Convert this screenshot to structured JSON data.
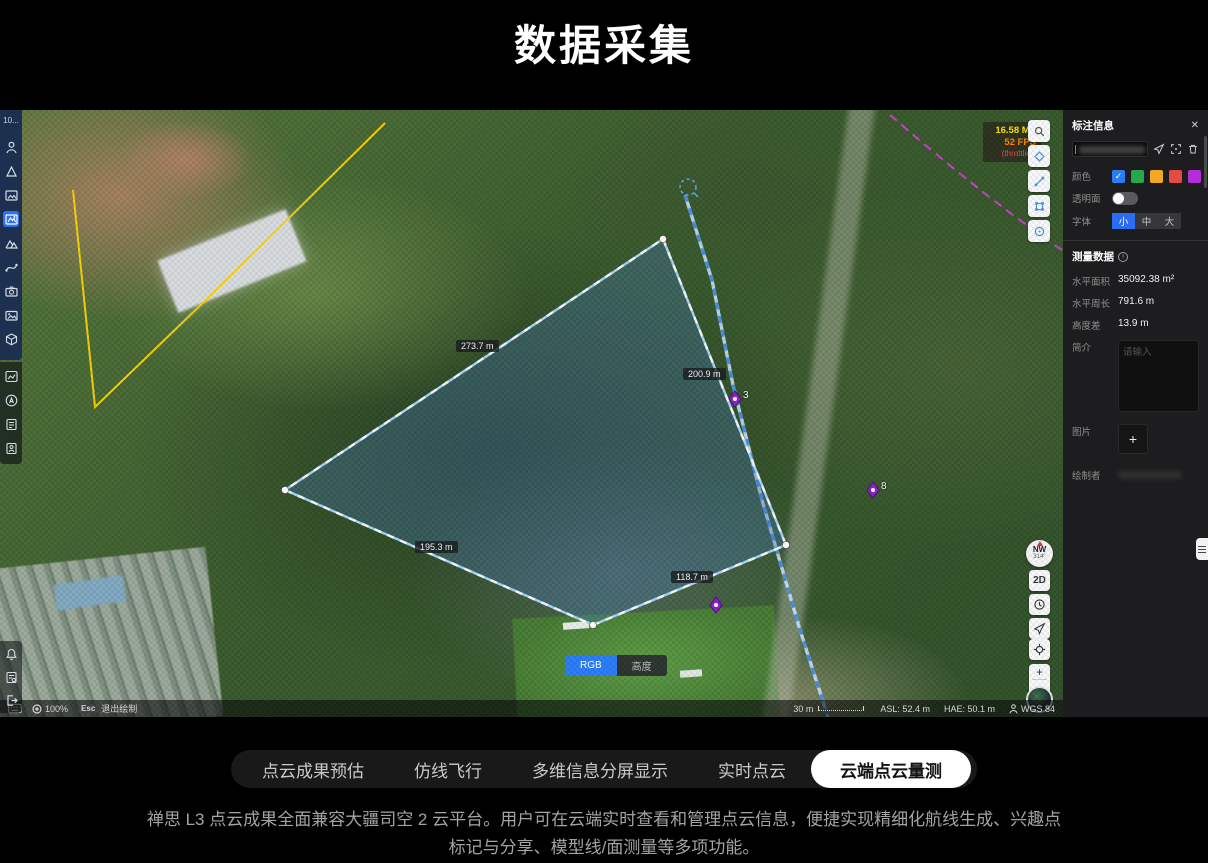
{
  "page": {
    "title": "数据采集"
  },
  "left_toolbar": {
    "truncated_label": "10..."
  },
  "map": {
    "perf": {
      "ms": "16.58 MS",
      "fps": "52 FPS",
      "note": "(throttled)"
    },
    "polygon": {
      "vertices": [
        [
          663,
          129
        ],
        [
          786,
          435
        ],
        [
          593,
          515
        ],
        [
          285,
          380
        ]
      ],
      "edge_labels": [
        {
          "text": "273.7 m",
          "x": 456,
          "y": 230
        },
        {
          "text": "200.9 m",
          "x": 683,
          "y": 258
        },
        {
          "text": "195.3 m",
          "x": 415,
          "y": 431
        },
        {
          "text": "118.7 m",
          "x": 671,
          "y": 461
        }
      ]
    },
    "markers": [
      {
        "x": 735,
        "y": 289,
        "label": "3"
      },
      {
        "x": 873,
        "y": 380,
        "label": "8"
      },
      {
        "x": 716,
        "y": 495,
        "label": ""
      }
    ],
    "compass": {
      "direction": "NW",
      "degrees": "314°"
    },
    "view_mode_label": "2D",
    "layer_toggle": {
      "rgb": "RGB",
      "height": "高度",
      "selected": "RGB"
    },
    "zoom_controls": {
      "plus": "+",
      "minus": "−"
    },
    "status_bar": {
      "zoom": "100%",
      "esc_key": "Esc",
      "esc_label": "退出绘制",
      "scale": "30 m",
      "asl": "ASL: 52.4 m",
      "hae": "HAE: 50.1 m",
      "datum": "WGS 84"
    }
  },
  "panel": {
    "title": "标注信息",
    "close": "✕",
    "color_label": "颜色",
    "colors": [
      "#2a7cf7",
      "#27a84e",
      "#f5a623",
      "#e24c42",
      "#b52dd6"
    ],
    "selected_color_check": "✓",
    "transparent_label": "透明面",
    "font_label": "字体",
    "font_options": [
      "小",
      "中",
      "大"
    ],
    "font_selected": "小",
    "measure_title": "测量数据",
    "info_glyph": "i",
    "rows": [
      {
        "label": "水平面积",
        "value": "35092.38 m²"
      },
      {
        "label": "水平周长",
        "value": "791.6 m"
      },
      {
        "label": "高度差",
        "value": "13.9 m"
      }
    ],
    "desc_label": "简介",
    "desc_placeholder": "请输入",
    "image_label": "图片",
    "add_label": "+",
    "creator_label": "绘制者"
  },
  "tabs": {
    "items": [
      "点云成果预估",
      "仿线飞行",
      "多维信息分屏显示",
      "实时点云",
      "云端点云量测"
    ],
    "selected": "云端点云量测"
  },
  "footer": {
    "description": "禅思 L3 点云成果全面兼容大疆司空 2 云平台。用户可在云端实时查看和管理点云信息，便捷实现精细化航线生成、兴趣点标记与分享、模型线/面测量等多项功能。"
  }
}
